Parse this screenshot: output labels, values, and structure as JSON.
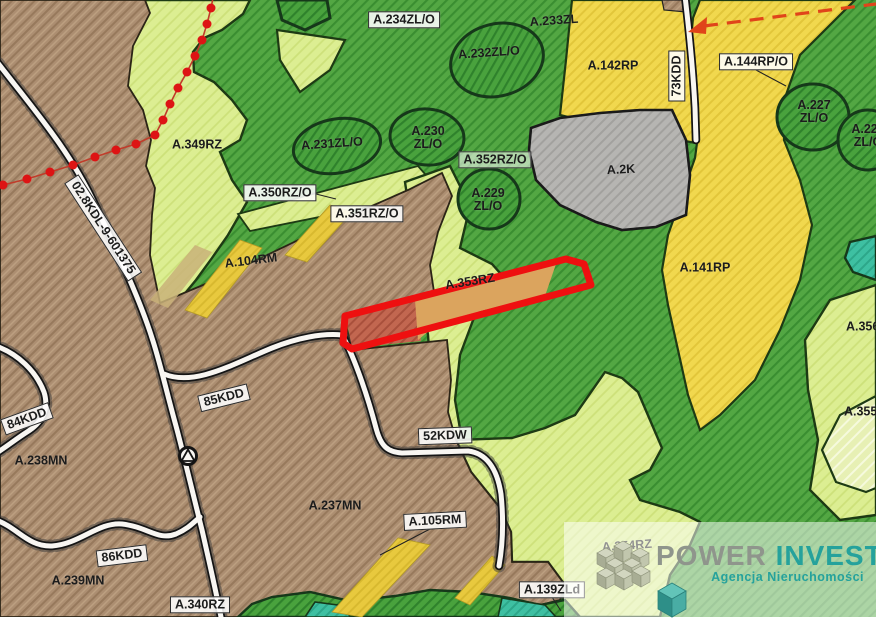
{
  "map": {
    "zone_labels": [
      {
        "text": "A.234ZL/O",
        "x": 404,
        "y": 20,
        "rot": 0,
        "boxed": true
      },
      {
        "text": "A.232ZL/O",
        "x": 489,
        "y": 53,
        "rot": -4,
        "boxed": false
      },
      {
        "text": "A.233ZL",
        "x": 554,
        "y": 21,
        "rot": -4,
        "boxed": false
      },
      {
        "text": "A.142RP",
        "x": 613,
        "y": 66,
        "rot": 0,
        "boxed": false
      },
      {
        "text": "73KDD",
        "x": 677,
        "y": 76,
        "rot": -90,
        "boxed": true
      },
      {
        "text": "A.144RP/O",
        "x": 756,
        "y": 62,
        "rot": 0,
        "boxed": true
      },
      {
        "text": "A.227\nZL/O",
        "x": 814,
        "y": 112,
        "rot": 0,
        "boxed": false
      },
      {
        "text": "A.226\nZL/O",
        "x": 868,
        "y": 136,
        "rot": 0,
        "boxed": false
      },
      {
        "text": "A.2K",
        "x": 621,
        "y": 170,
        "rot": -3,
        "boxed": false
      },
      {
        "text": "A.141RP",
        "x": 705,
        "y": 268,
        "rot": 0,
        "boxed": false
      },
      {
        "text": "A.349RZ",
        "x": 197,
        "y": 145,
        "rot": 0,
        "boxed": false
      },
      {
        "text": "A.231ZL/O",
        "x": 332,
        "y": 144,
        "rot": -4,
        "boxed": false
      },
      {
        "text": "A.230\nZL/O",
        "x": 428,
        "y": 138,
        "rot": 0,
        "boxed": false
      },
      {
        "text": "A.352RZ/O",
        "x": 495,
        "y": 160,
        "rot": 0,
        "boxed": true,
        "thin": true
      },
      {
        "text": "A.229\nZL/O",
        "x": 488,
        "y": 200,
        "rot": 0,
        "boxed": false
      },
      {
        "text": "A.350RZ/O",
        "x": 280,
        "y": 193,
        "rot": 0,
        "boxed": true
      },
      {
        "text": "A.351RZ/O",
        "x": 367,
        "y": 214,
        "rot": 0,
        "boxed": true
      },
      {
        "text": "A.104RM",
        "x": 251,
        "y": 261,
        "rot": -7,
        "boxed": false
      },
      {
        "text": "02.8KDL-9-601375",
        "x": 103,
        "y": 228,
        "rot": 57,
        "boxed": true
      },
      {
        "text": "A.353RZ",
        "x": 470,
        "y": 282,
        "rot": -9,
        "boxed": false
      },
      {
        "text": "85KDD",
        "x": 224,
        "y": 398,
        "rot": -14,
        "boxed": true
      },
      {
        "text": "84KDD",
        "x": 27,
        "y": 419,
        "rot": -20,
        "boxed": true
      },
      {
        "text": "A.238MN",
        "x": 41,
        "y": 461,
        "rot": 0,
        "boxed": false
      },
      {
        "text": "52KDW",
        "x": 445,
        "y": 436,
        "rot": -2,
        "boxed": true
      },
      {
        "text": "A.237MN",
        "x": 335,
        "y": 506,
        "rot": 0,
        "boxed": false
      },
      {
        "text": "A.105RM",
        "x": 435,
        "y": 521,
        "rot": -3,
        "boxed": true
      },
      {
        "text": "86KDD",
        "x": 122,
        "y": 556,
        "rot": -7,
        "boxed": true
      },
      {
        "text": "A.239MN",
        "x": 78,
        "y": 581,
        "rot": 0,
        "boxed": false
      },
      {
        "text": "A.340RZ",
        "x": 200,
        "y": 605,
        "rot": 0,
        "boxed": true
      },
      {
        "text": "A.139ZLd",
        "x": 552,
        "y": 590,
        "rot": 0,
        "boxed": true
      },
      {
        "text": "A.354RZ",
        "x": 627,
        "y": 546,
        "rot": -4,
        "boxed": false
      },
      {
        "text": "A.356RZ",
        "x": 871,
        "y": 327,
        "rot": 0,
        "boxed": false
      },
      {
        "text": "A.355RZ",
        "x": 869,
        "y": 412,
        "rot": 0,
        "boxed": false
      }
    ],
    "highlight": {
      "plot_label": "A.353RZ",
      "outline_color": "#ee1010"
    },
    "palette": {
      "forest_green": "#53a743",
      "forest_green_dark": "#49a23d",
      "meadow_light_green": "#dcee92",
      "farmland_yellow": "#f1d84e",
      "residential_brown": "#ac8e71",
      "infrastructure_gray": "#b6b5b2",
      "water_teal": "#3ec0a2",
      "plot_tan": "#dba45e",
      "plot_red_brown": "#c26750",
      "road_white": "#f8f6f2",
      "boundary_red_dots": "#dd1414",
      "direction_dash_red": "#e0441a"
    }
  },
  "logo": {
    "power": "POWER",
    "invest": "INVEST",
    "subtitle": "Agencja Nieruchomości",
    "power_color": "#8f958c",
    "invest_color": "#25a29c"
  }
}
